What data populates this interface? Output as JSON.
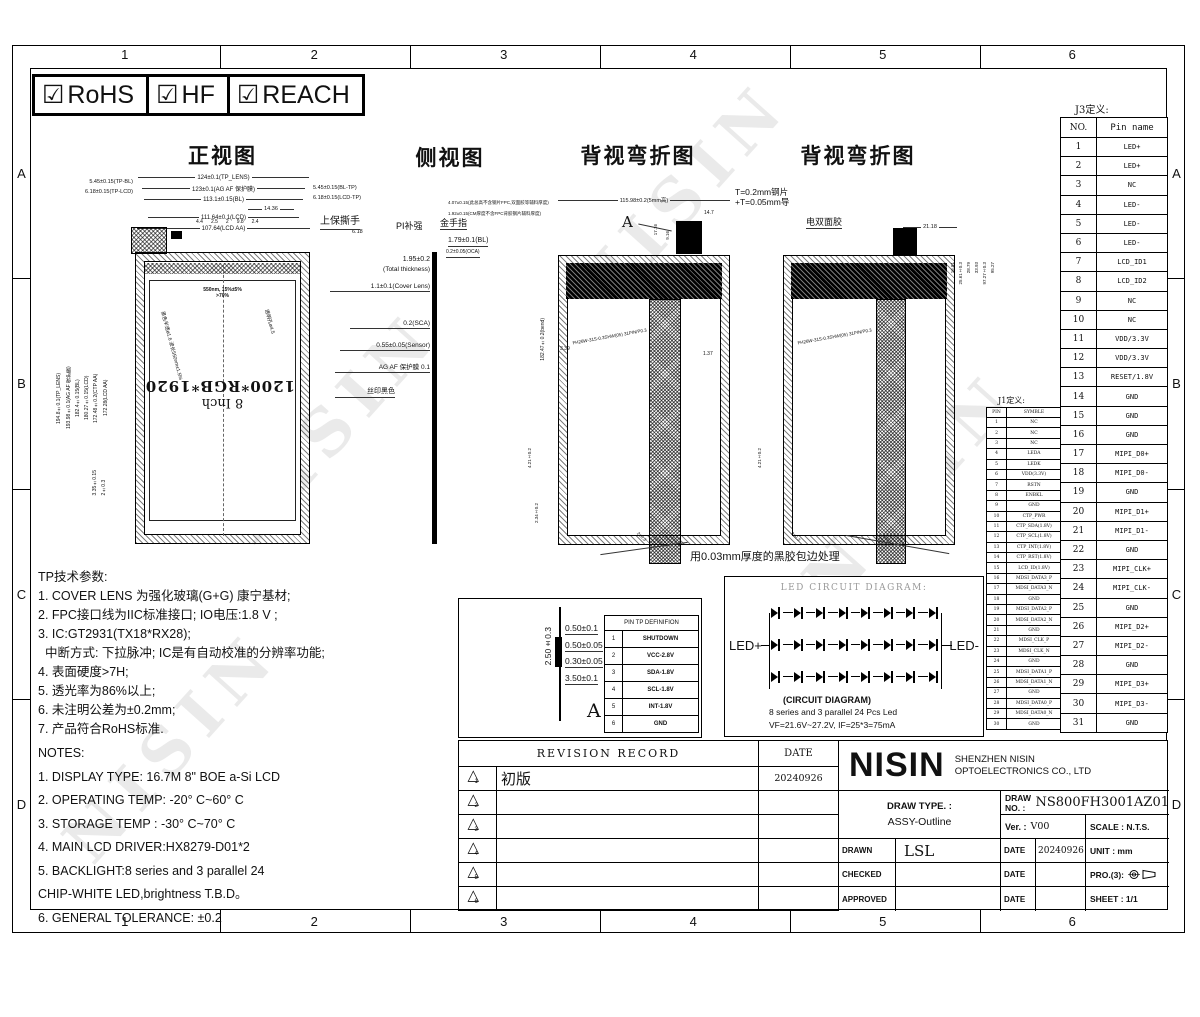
{
  "frame": {
    "cols": [
      "1",
      "2",
      "3",
      "4",
      "5",
      "6"
    ],
    "rows": [
      "A",
      "B",
      "C",
      "D"
    ]
  },
  "certs": [
    {
      "check": "☑",
      "label": "RoHS"
    },
    {
      "check": "☑",
      "label": "HF"
    },
    {
      "check": "☑",
      "label": "REACH"
    }
  ],
  "titles": {
    "front": "正视图",
    "side": "侧视图",
    "back1": "背视弯折图",
    "back2": "背视弯折图"
  },
  "front": {
    "dims_top": [
      "124±0.1(TP_LENS)",
      "123±0.1(AG AF 保护膜)",
      "113.1±0.15(BL)",
      "111.64±0.1(LCD)",
      "107.64(LCD AA)"
    ],
    "left_top_dims": [
      "5.45±0.15(TP-BL)",
      "6.18±0.15(TP-LCD)"
    ],
    "right_top_dims": [
      "5.45±0.15(BL-TP)",
      "6.18±0.15(LCD-TP)"
    ],
    "dim_618": "6.18",
    "small_dims": [
      "4.4",
      "2.5",
      "2",
      "9.8",
      "2.4"
    ],
    "dim_1436": "14.36",
    "tab_label": "上保撕手",
    "left_dims": [
      "194.8±0.1(TP_LENS)",
      "193.98±0.1(AG AF 保护膜)",
      "182.4±0.15(BL)",
      "180.27±0.15(LCD)",
      "172.48±0.2(CTP AA)",
      "172.28(LCD AA)"
    ],
    "bottom_left_dims": [
      "3.35±0.15",
      "2±0.3"
    ],
    "screen_size": "8 Inch",
    "screen_res": "1200*RGB*1920",
    "ink_note1": "550nm, 15%±5%",
    "ink_note2": ">70%",
    "hole_note_left": "黑色半透ø1.6 波长550nm±1.5%",
    "hole_note_right": "透明孔ø4.5"
  },
  "side": {
    "total1": "1.95±0.2",
    "total2": "(Total thickness)",
    "cover": "1.1±0.1(Cover Lens)",
    "sca": "0.2(SCA)",
    "sensor": "0.55±0.05(Sensor)",
    "agaf": "AG AF 保护膜 0.1",
    "silk": "丝印黑色",
    "pi": "PI补强",
    "gold": "金手指",
    "small1": "4.07±0.15(此总高不含钢片FPC,双面胶等辅料厚度)",
    "small2": "1.92±0.15(CM厚度不含FPC背胶钢片辅料厚度)",
    "bl": "1.79±0.1(BL)",
    "oca": "0.2±0.05(OCA)"
  },
  "back1": {
    "dim_top": "115.98±0.2(5mm高)",
    "label_a": "A",
    "dim_147": "14.7",
    "dim_1716": "17.16",
    "dim_916": "9.16",
    "dim_339": "3.39",
    "dim_137": "1.37",
    "connector": "FH26W-31S-0.3SHW(05) 31PIN/P0.3",
    "dim_bend": "182.47±0.2(bend)",
    "dim_421": "4.21±0.2",
    "dim_234": "2.34±0.2",
    "dim_corner": "2±0.3"
  },
  "back2": {
    "steel_note1": "T=0.2mm钢片",
    "steel_note2": "+T=0.05mm导",
    "tape_note": "电双面胶",
    "dim_2118": "21.18",
    "right_dims": [
      "16.81",
      "25.61±0.3",
      "28.79",
      "33.93",
      "97.27±0.3",
      "95.27"
    ],
    "dim_421": "4.21±0.2",
    "dim_corner": "2±0.3"
  },
  "back_note": "用0.03mm厚度的黑胶包边处理",
  "j1": {
    "title": "J1定义:",
    "headers": [
      "PIN",
      "SYMBLE"
    ],
    "rows": [
      [
        "1",
        "NC"
      ],
      [
        "2",
        "NC"
      ],
      [
        "3",
        "NC"
      ],
      [
        "4",
        "LEDA"
      ],
      [
        "5",
        "LEDK"
      ],
      [
        "6",
        "VDD(3.3V)"
      ],
      [
        "7",
        "RSTN"
      ],
      [
        "8",
        "ENBKL"
      ],
      [
        "9",
        "GND"
      ],
      [
        "10",
        "CTP_PWR"
      ],
      [
        "11",
        "CTP_SDA(1.8V)"
      ],
      [
        "12",
        "CTP_SCL(1.8V)"
      ],
      [
        "13",
        "CTP_INT(1.8V)"
      ],
      [
        "14",
        "CTP_RST(1.8V)"
      ],
      [
        "15",
        "LCD_ID(1.8V)"
      ],
      [
        "16",
        "MDSI_DATA3_P"
      ],
      [
        "17",
        "MDSI_DATA3_N"
      ],
      [
        "18",
        "GND"
      ],
      [
        "19",
        "MDSI_DATA2_P"
      ],
      [
        "20",
        "MDSI_DATA2_N"
      ],
      [
        "21",
        "GND"
      ],
      [
        "22",
        "MDSI_CLK_P"
      ],
      [
        "23",
        "MDSI_CLK_N"
      ],
      [
        "24",
        "GND"
      ],
      [
        "25",
        "MDSI_DATA1_P"
      ],
      [
        "26",
        "MDSI_DATA1_N"
      ],
      [
        "27",
        "GND"
      ],
      [
        "28",
        "MDSI_DATA0_P"
      ],
      [
        "29",
        "MDSI_DATA0_N"
      ],
      [
        "30",
        "GND"
      ]
    ]
  },
  "j3": {
    "title": "J3定义:",
    "headers": [
      "NO.",
      "Pin name"
    ],
    "rows": [
      [
        "1",
        "LED+"
      ],
      [
        "2",
        "LED+"
      ],
      [
        "3",
        "NC"
      ],
      [
        "4",
        "LED-"
      ],
      [
        "5",
        "LED-"
      ],
      [
        "6",
        "LED-"
      ],
      [
        "7",
        "LCD_ID1"
      ],
      [
        "8",
        "LCD_ID2"
      ],
      [
        "9",
        "NC"
      ],
      [
        "10",
        "NC"
      ],
      [
        "11",
        "VDD/3.3V"
      ],
      [
        "12",
        "VDD/3.3V"
      ],
      [
        "13",
        "RESET/1.8V"
      ],
      [
        "14",
        "GND"
      ],
      [
        "15",
        "GND"
      ],
      [
        "16",
        "GND"
      ],
      [
        "17",
        "MIPI_D0+"
      ],
      [
        "18",
        "MIPI_D0-"
      ],
      [
        "19",
        "GND"
      ],
      [
        "20",
        "MIPI_D1+"
      ],
      [
        "21",
        "MIPI_D1-"
      ],
      [
        "22",
        "GND"
      ],
      [
        "23",
        "MIPI_CLK+"
      ],
      [
        "24",
        "MIPI_CLK-"
      ],
      [
        "25",
        "GND"
      ],
      [
        "26",
        "MIPI_D2+"
      ],
      [
        "27",
        "MIPI_D2-"
      ],
      [
        "28",
        "GND"
      ],
      [
        "29",
        "MIPI_D3+"
      ],
      [
        "30",
        "MIPI_D3-"
      ],
      [
        "31",
        "GND"
      ]
    ]
  },
  "tp_notes": {
    "title": "TP技术参数:",
    "lines": [
      "1. COVER LENS 为强化玻璃(G+G) 康宁基材;",
      "2. FPC接口线为IIC标准接口; IO电压:1.8 V ;",
      "3. IC:GT2931(TX18*RX28);",
      "  中断方式: 下拉脉冲; IC是有自动校准的分辨率功能;",
      "4. 表面硬度>7H;",
      "5. 透光率为86%以上;",
      "6. 未注明公差为±0.2mm;",
      "7. 产品符合RoHS标准."
    ]
  },
  "notes": {
    "title": "NOTES:",
    "lines": [
      "1. DISPLAY TYPE: 16.7M 8\" BOE a-Si LCD",
      "2. OPERATING TEMP: -20° C~60° C",
      "3. STORAGE TEMP : -30° C~70° C",
      "4. MAIN LCD DRIVER:HX8279-D01*2",
      "5. BACKLIGHT:8 series and 3 parallel 24",
      "CHIP-WHITE LED,brightness T.B.D。",
      "6. GENERAL TOLERANCE: ±0.2"
    ]
  },
  "detail_a": {
    "dims": [
      "0.50±0.1",
      "0.50±0.05",
      "0.30±0.05",
      "3.50±0.1"
    ],
    "vdim": "2.50±0.3",
    "label": "A"
  },
  "tp_pins": {
    "header": "PIN TP DEFINIFION",
    "rows": [
      [
        "1",
        "SHUTDOWN"
      ],
      [
        "2",
        "VCC-2.8V"
      ],
      [
        "3",
        "SDA-1.8V"
      ],
      [
        "4",
        "SCL-1.8V"
      ],
      [
        "5",
        "INT-1.8V"
      ],
      [
        "6",
        "GND"
      ]
    ]
  },
  "led_circuit": {
    "title": "LED CIRCUIT DIAGRAM:",
    "left": "LED+",
    "right": "LED-",
    "cap1": "(CIRCUIT DIAGRAM)",
    "cap2": "8 series and 3 parallel 24 Pcs Led",
    "cap3": "VF=21.6V~27.2V, IF=25*3=75mA"
  },
  "revision": {
    "header": "REVISION RECORD",
    "date_header": "DATE",
    "rows": [
      {
        "no": "1",
        "desc": "初版",
        "date": "20240926"
      },
      {
        "no": "2",
        "desc": "",
        "date": ""
      },
      {
        "no": "3",
        "desc": "",
        "date": ""
      },
      {
        "no": "4",
        "desc": "",
        "date": ""
      },
      {
        "no": "5",
        "desc": "",
        "date": ""
      },
      {
        "no": "6",
        "desc": "",
        "date": ""
      }
    ]
  },
  "title_block": {
    "logo": "NISIN",
    "company1": "SHENZHEN NISIN",
    "company2": "OPTOELECTRONICS CO., LTD",
    "draw_type_label": "DRAW TYPE. :",
    "draw_type": "ASSY-Outline",
    "draw_no_label": "DRAW NO. :",
    "draw_no": "NS800FH3001AZ01",
    "ver_label": "Ver. :",
    "ver": "V00",
    "scale": "SCALE : N.T.S.",
    "drawn_label": "DRAWN",
    "drawn": "LSL",
    "date_label": "DATE",
    "drawn_date": "20240926",
    "unit": "UNIT : mm",
    "checked_label": "CHECKED",
    "approved_label": "APPROVED",
    "pro_label": "PRO.(3):",
    "sheet": "SHEET : 1/1"
  },
  "watermark": "NISIN"
}
